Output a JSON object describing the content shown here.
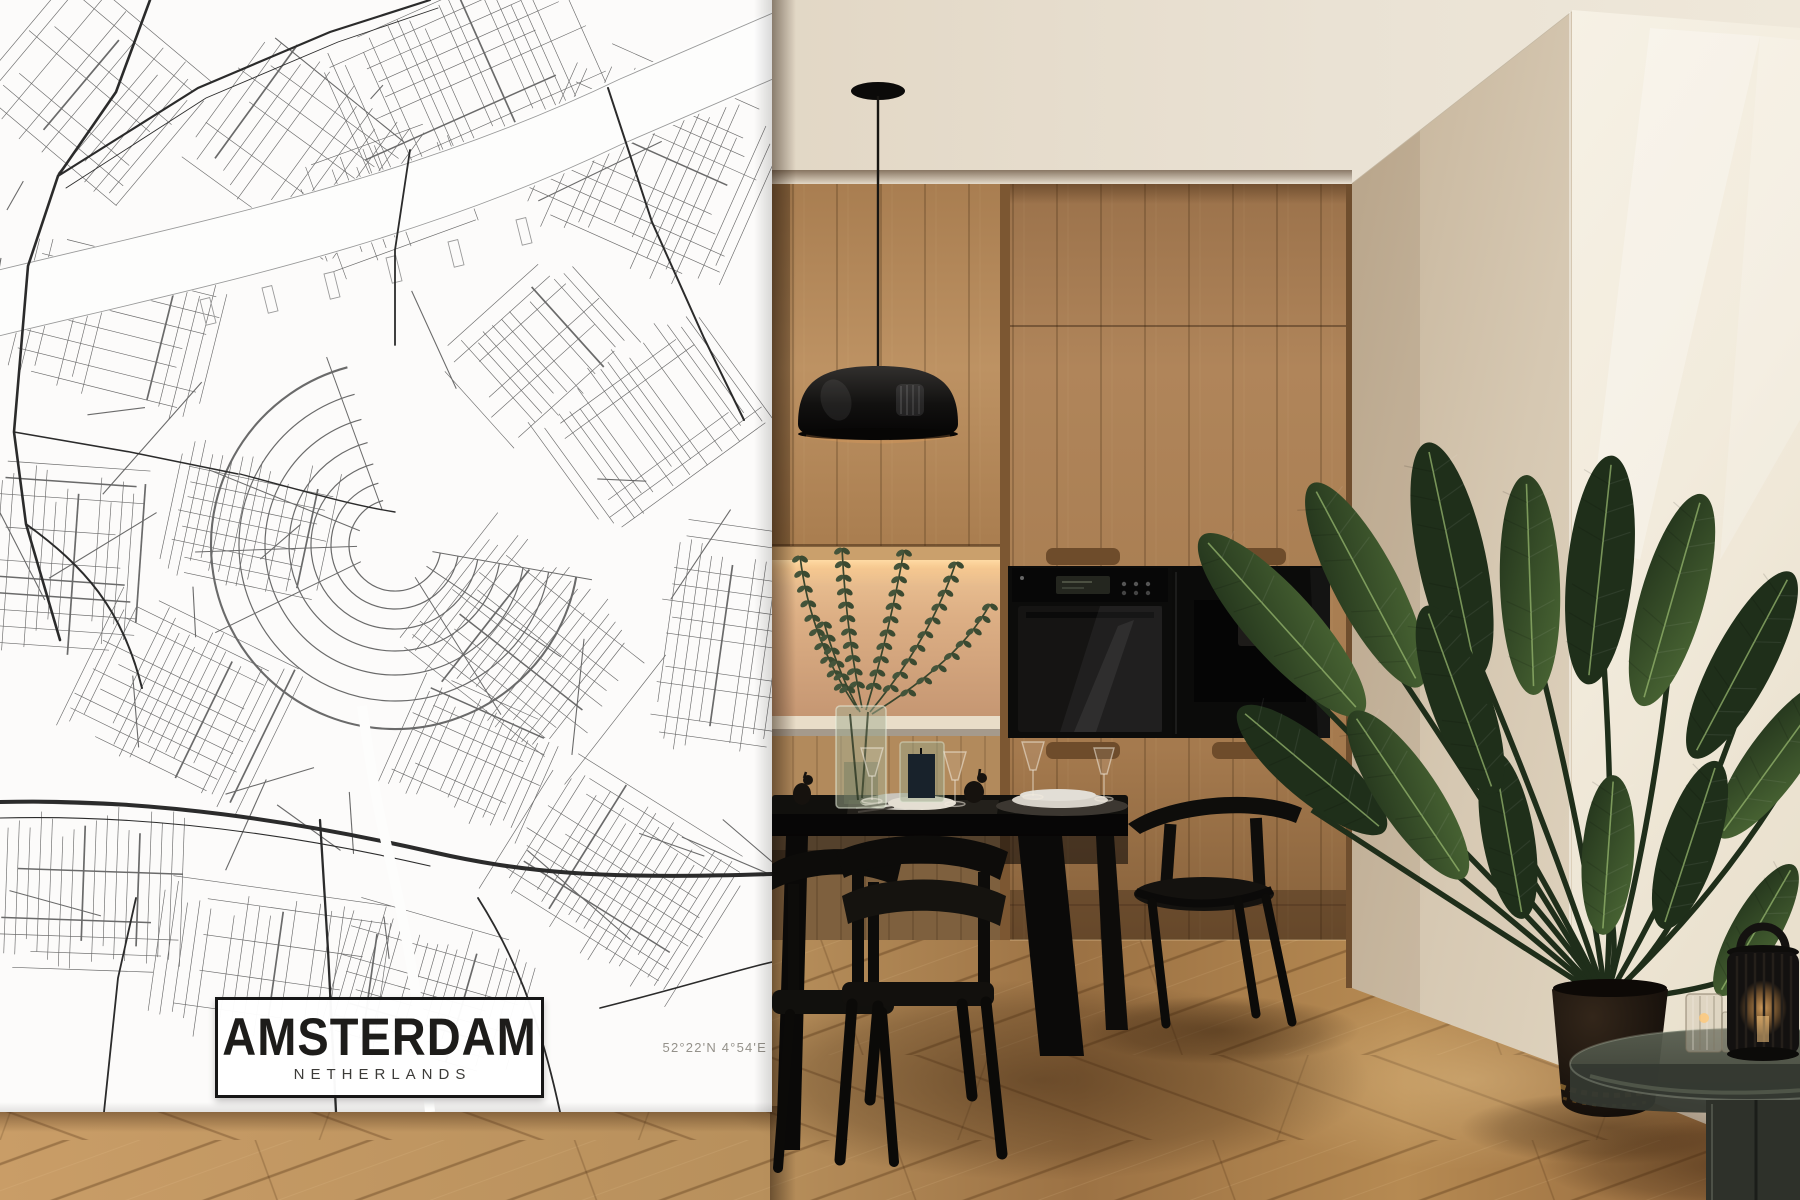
{
  "poster": {
    "title": "AMSTERDAM",
    "subtitle": "NETHERLANDS",
    "coordinates": "52°22'N 4°54'E"
  },
  "palette": {
    "poster_bg": "#fcfbfa",
    "map_ink": "#5a5a5a",
    "map_ink_dark": "#2b2b2b",
    "map_ink_light": "#9a9a9a",
    "title_ink": "#1d1c1a",
    "coord_ink": "#94918a",
    "ceiling": "#e9e1d3",
    "wood": "#ae8356",
    "wood_dark": "#7c5732",
    "backsplash": "#d8a87c",
    "shelf_glow": "#ffdca6",
    "appliance": "#0c0c0b",
    "side_wall": "#d6c8b2",
    "front_wall": "#f4eee1",
    "floor_light": "#c79a63",
    "floor_dark": "#8a6239",
    "black_furniture": "#0e0d0b",
    "leaf_dark": "#20301a",
    "leaf_light": "#4d6a36",
    "pot": "#1a130d",
    "glow_amber": "#d9984e"
  }
}
